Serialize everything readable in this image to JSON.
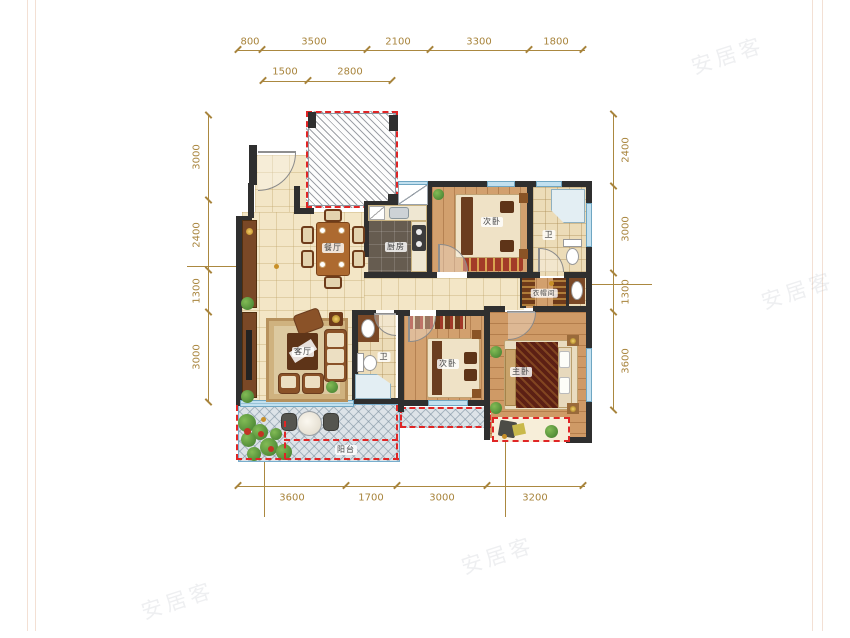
{
  "watermark": {
    "text": "安居客"
  },
  "rooms": {
    "dining": {
      "label": "餐厅"
    },
    "kitchen": {
      "label": "厨房"
    },
    "bedroom_top": {
      "label": "次卧"
    },
    "bath_top": {
      "label": "卫"
    },
    "closet": {
      "label": "衣帽间"
    },
    "living": {
      "label": "客厅"
    },
    "bath_mid": {
      "label": "卫"
    },
    "bedroom_mid": {
      "label": "次卧"
    },
    "master": {
      "label": "主卧"
    },
    "balcony": {
      "label": "阳台"
    }
  },
  "dimensions": {
    "top_row1": [
      "800",
      "3500",
      "2100",
      "3300",
      "1800"
    ],
    "top_row2": [
      "1500",
      "2800"
    ],
    "left": [
      "3000",
      "2400",
      "1300",
      "3000"
    ],
    "right": [
      "2400",
      "3000",
      "1300",
      "3600"
    ],
    "bottom": [
      "3600",
      "1700",
      "3000",
      "3200"
    ]
  },
  "colors": {
    "dimension_text": "#a8843c",
    "wall": "#2f2f2f",
    "red_dashed": "#e02525",
    "window_blue": "#c2e0ef"
  }
}
